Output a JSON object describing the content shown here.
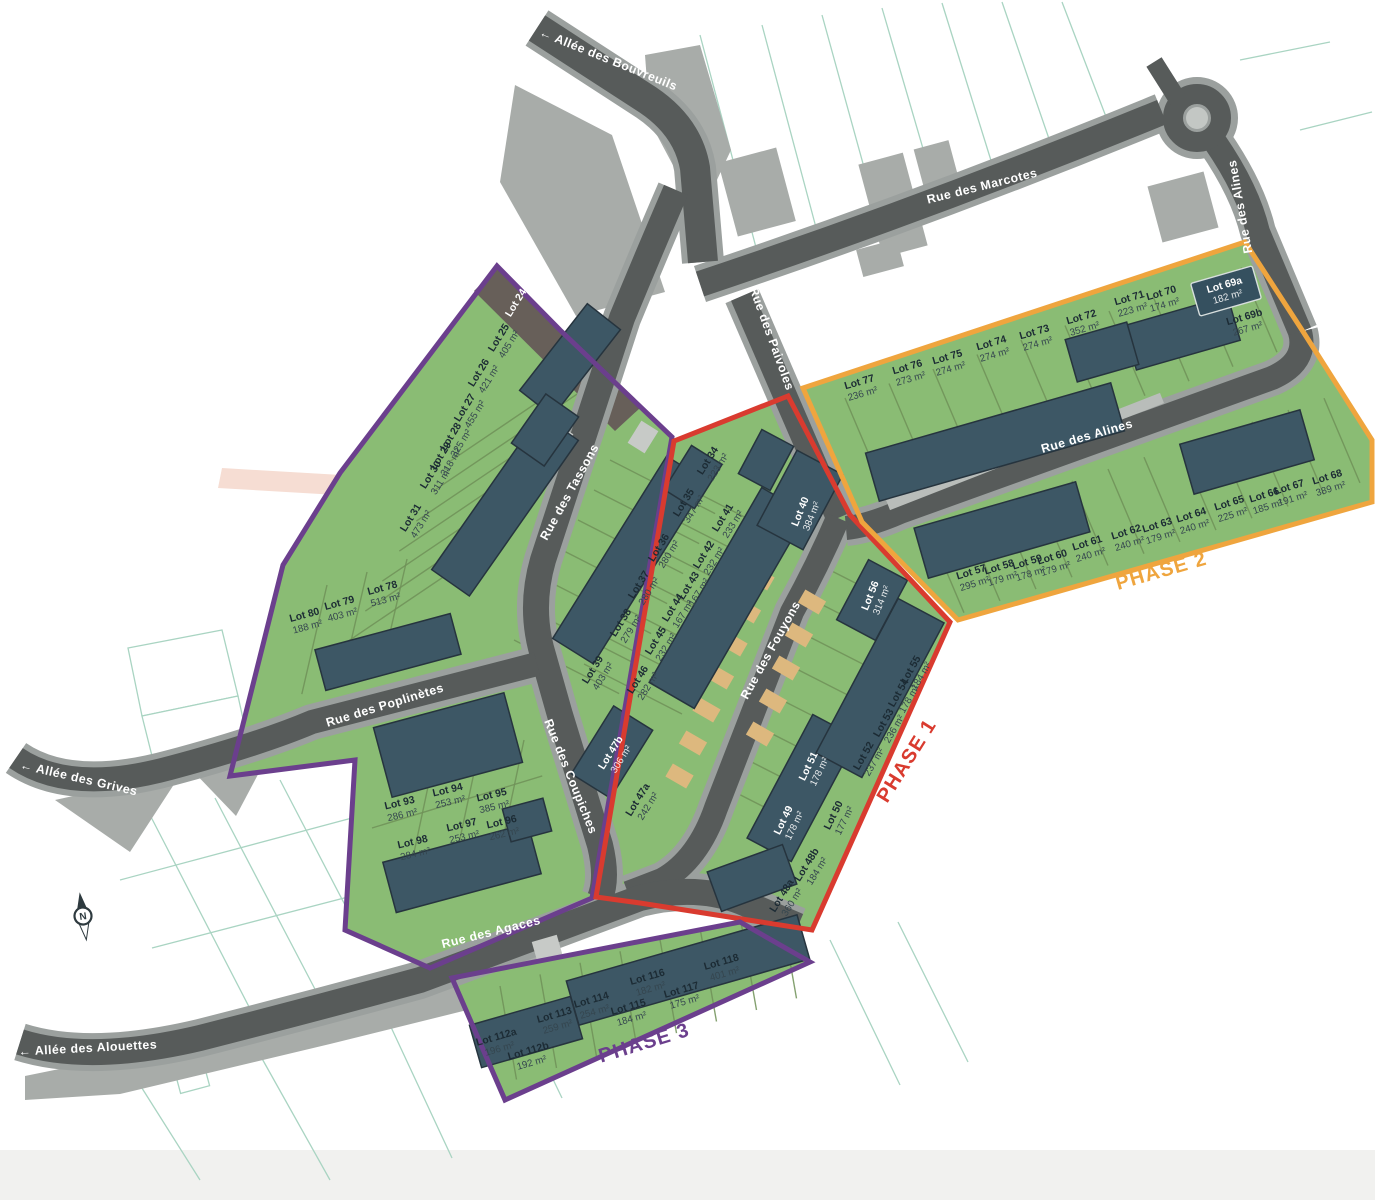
{
  "map_type": "residential-subdivision-plan",
  "colors": {
    "road": "#575b5a",
    "road_casing": "#9ba09e",
    "parcel_green": "#8abc74",
    "divider_green": "#6f9158",
    "building": "#3d5765",
    "building_outline": "#26343e",
    "existing_gray": "#a8aca9",
    "driveway_tan": "#ddb87e",
    "pad_gray": "#c7cac7",
    "phase1_red": "#d93b2f",
    "phase2_orange": "#efa53e",
    "phase3_purple": "#6b3f8d",
    "parcel_line_teal": "#a9d4c2",
    "label_dark": "#1c2b34",
    "label_area_dark": "#35464f",
    "label_white": "#ffffff",
    "lot24_strip": "#675f59",
    "bottom_band": "#f1f1ef",
    "pink_zone": "#f6ddd3"
  },
  "north": {
    "label": "N",
    "x": 83,
    "y": 916
  },
  "streets": [
    {
      "name": "← Allée des Bouvreuils",
      "x": 607,
      "y": 63,
      "rot": 22
    },
    {
      "name": "Rue des Marcotes",
      "x": 983,
      "y": 190,
      "rot": -14
    },
    {
      "name": "Rue des Alines",
      "x": 1244,
      "y": 206,
      "rot": -100
    },
    {
      "name": "Rue des Alines",
      "x": 1088,
      "y": 440,
      "rot": -16
    },
    {
      "name": "Rue des Paivoles",
      "x": 768,
      "y": 340,
      "rot": 70
    },
    {
      "name": "Rue des Tassons",
      "x": 573,
      "y": 494,
      "rot": -61
    },
    {
      "name": "Rue des Fouyons",
      "x": 774,
      "y": 652,
      "rot": -61
    },
    {
      "name": "Rue des Poplinètes",
      "x": 386,
      "y": 709,
      "rot": -17
    },
    {
      "name": "Rue des Coupiches",
      "x": 567,
      "y": 778,
      "rot": 68
    },
    {
      "name": "Rue des Agaces",
      "x": 492,
      "y": 936,
      "rot": -14
    },
    {
      "name": "← Allée des Grives",
      "x": 78,
      "y": 782,
      "rot": 13
    },
    {
      "name": "← Allée des Alouettes",
      "x": 88,
      "y": 1052,
      "rot": -3
    }
  ],
  "phases": [
    {
      "name": "PHASE 1",
      "color": "#d93b2f",
      "x": 912,
      "y": 764,
      "rot": -58
    },
    {
      "name": "PHASE 2",
      "color": "#efa53e",
      "x": 1163,
      "y": 577,
      "rot": -16
    },
    {
      "name": "PHASE 3",
      "color": "#6b3f8d",
      "x": 646,
      "y": 1049,
      "rot": -17
    }
  ],
  "lots": [
    {
      "id": "Lot 24",
      "area": null,
      "x": 516,
      "y": 303,
      "rot": -58,
      "white": true
    },
    {
      "id": "Lot 25",
      "area": "405 m²",
      "x": 504,
      "y": 341,
      "rot": -58
    },
    {
      "id": "Lot 26",
      "area": "421 m²",
      "x": 484,
      "y": 376,
      "rot": -58
    },
    {
      "id": "Lot 27",
      "area": "455 m²",
      "x": 470,
      "y": 411,
      "rot": -58
    },
    {
      "id": "Lot 28",
      "area": "325 m²",
      "x": 456,
      "y": 440,
      "rot": -58
    },
    {
      "id": "Lot 29",
      "area": "318 m²",
      "x": 446,
      "y": 459,
      "rot": -58
    },
    {
      "id": "Lot 30",
      "area": "311 m²",
      "x": 436,
      "y": 478,
      "rot": -58
    },
    {
      "id": "Lot 31",
      "area": "473 m²",
      "x": 416,
      "y": 521,
      "rot": -58
    },
    {
      "id": "Lot 34",
      "area": "223 m²",
      "x": 713,
      "y": 464,
      "rot": -58
    },
    {
      "id": "Lot 35",
      "area": "347 m²",
      "x": 689,
      "y": 506,
      "rot": -58
    },
    {
      "id": "Lot 36",
      "area": "280 m²",
      "x": 664,
      "y": 551,
      "rot": -58
    },
    {
      "id": "Lot 37",
      "area": "280 m²",
      "x": 644,
      "y": 588,
      "rot": -58
    },
    {
      "id": "Lot 38",
      "area": "279 m²",
      "x": 626,
      "y": 626,
      "rot": -58
    },
    {
      "id": "Lot 39",
      "area": "403 m²",
      "x": 598,
      "y": 673,
      "rot": -58
    },
    {
      "id": "Lot 40",
      "area": "384 m²",
      "x": 806,
      "y": 514,
      "rot": -68,
      "white": true
    },
    {
      "id": "Lot 41",
      "area": "233 m²",
      "x": 728,
      "y": 521,
      "rot": -58
    },
    {
      "id": "Lot 42",
      "area": "232 m²",
      "x": 709,
      "y": 558,
      "rot": -58
    },
    {
      "id": "Lot 43",
      "area": "167 m²",
      "x": 694,
      "y": 589,
      "rot": -58
    },
    {
      "id": "Lot 44",
      "area": "167 m²",
      "x": 678,
      "y": 611,
      "rot": -58
    },
    {
      "id": "Lot 45",
      "area": "232 m²",
      "x": 661,
      "y": 644,
      "rot": -58
    },
    {
      "id": "Lot 46",
      "area": "282 m²",
      "x": 643,
      "y": 683,
      "rot": -58
    },
    {
      "id": "Lot 47b",
      "area": "306 m²",
      "x": 616,
      "y": 756,
      "rot": -58,
      "white": true
    },
    {
      "id": "Lot 47a",
      "area": "242 m²",
      "x": 643,
      "y": 803,
      "rot": -58
    },
    {
      "id": "Lot 48a",
      "area": "360 m²",
      "x": 787,
      "y": 899,
      "rot": -58
    },
    {
      "id": "Lot 48b",
      "area": "184 m²",
      "x": 812,
      "y": 868,
      "rot": -58
    },
    {
      "id": "Lot 49",
      "area": "178 m²",
      "x": 789,
      "y": 823,
      "rot": -64,
      "white": true
    },
    {
      "id": "Lot 50",
      "area": "177 m²",
      "x": 839,
      "y": 818,
      "rot": -64
    },
    {
      "id": "Lot 51",
      "area": "178 m²",
      "x": 814,
      "y": 769,
      "rot": -64,
      "white": true
    },
    {
      "id": "Lot 52",
      "area": "237 m²",
      "x": 869,
      "y": 759,
      "rot": -60
    },
    {
      "id": "Lot 53",
      "area": "236 m²",
      "x": 889,
      "y": 726,
      "rot": -60
    },
    {
      "id": "Lot 54",
      "area": "178 m²",
      "x": 904,
      "y": 696,
      "rot": -60
    },
    {
      "id": "Lot 55",
      "area": "184 m²",
      "x": 916,
      "y": 673,
      "rot": -60
    },
    {
      "id": "Lot 56",
      "area": "314 m²",
      "x": 876,
      "y": 598,
      "rot": -68,
      "white": true
    },
    {
      "id": "Lot 57",
      "area": "295 m²",
      "x": 973,
      "y": 578,
      "rot": -17
    },
    {
      "id": "Lot 58",
      "area": "179 m²",
      "x": 1001,
      "y": 573,
      "rot": -17
    },
    {
      "id": "Lot 59",
      "area": "178 m²",
      "x": 1029,
      "y": 568,
      "rot": -17
    },
    {
      "id": "Lot 60",
      "area": "179 m²",
      "x": 1054,
      "y": 563,
      "rot": -17
    },
    {
      "id": "Lot 61",
      "area": "240 m²",
      "x": 1089,
      "y": 549,
      "rot": -17
    },
    {
      "id": "Lot 62",
      "area": "240 m²",
      "x": 1128,
      "y": 538,
      "rot": -17
    },
    {
      "id": "Lot 63",
      "area": "179 m²",
      "x": 1159,
      "y": 531,
      "rot": -17
    },
    {
      "id": "Lot 64",
      "area": "240 m²",
      "x": 1193,
      "y": 521,
      "rot": -17
    },
    {
      "id": "Lot 65",
      "area": "225 m²",
      "x": 1231,
      "y": 509,
      "rot": -17
    },
    {
      "id": "Lot 66",
      "area": "185 m²",
      "x": 1266,
      "y": 501,
      "rot": -17
    },
    {
      "id": "Lot 67",
      "area": "191 m²",
      "x": 1291,
      "y": 493,
      "rot": -17
    },
    {
      "id": "Lot 68",
      "area": "389 m²",
      "x": 1329,
      "y": 483,
      "rot": -17
    },
    {
      "id": "Lot 69a",
      "area": "182 m²",
      "x": 1226,
      "y": 291,
      "rot": -16,
      "white": true,
      "badge": true
    },
    {
      "id": "Lot 69b",
      "area": "267 m²",
      "x": 1246,
      "y": 323,
      "rot": -16
    },
    {
      "id": "Lot 70",
      "area": "174 m²",
      "x": 1163,
      "y": 299,
      "rot": -16
    },
    {
      "id": "Lot 71",
      "area": "223 m²",
      "x": 1131,
      "y": 304,
      "rot": -16
    },
    {
      "id": "Lot 72",
      "area": "352 m²",
      "x": 1083,
      "y": 323,
      "rot": -16
    },
    {
      "id": "Lot 73",
      "area": "274 m²",
      "x": 1036,
      "y": 338,
      "rot": -16
    },
    {
      "id": "Lot 74",
      "area": "274 m²",
      "x": 993,
      "y": 349,
      "rot": -16
    },
    {
      "id": "Lot 75",
      "area": "274 m²",
      "x": 949,
      "y": 363,
      "rot": -16
    },
    {
      "id": "Lot 76",
      "area": "273 m²",
      "x": 909,
      "y": 373,
      "rot": -16
    },
    {
      "id": "Lot 77",
      "area": "236 m²",
      "x": 861,
      "y": 388,
      "rot": -16
    },
    {
      "id": "Lot 78",
      "area": "513 m²",
      "x": 384,
      "y": 594,
      "rot": -15
    },
    {
      "id": "Lot 79",
      "area": "403 m²",
      "x": 341,
      "y": 609,
      "rot": -15
    },
    {
      "id": "Lot 80",
      "area": "188 m²",
      "x": 306,
      "y": 621,
      "rot": -15
    },
    {
      "id": "Lot 93",
      "area": "286 m²",
      "x": 401,
      "y": 809,
      "rot": -13
    },
    {
      "id": "Lot 94",
      "area": "253 m²",
      "x": 449,
      "y": 796,
      "rot": -13
    },
    {
      "id": "Lot 95",
      "area": "385 m²",
      "x": 493,
      "y": 801,
      "rot": -13
    },
    {
      "id": "Lot 96",
      "area": "262 m²",
      "x": 503,
      "y": 828,
      "rot": -13
    },
    {
      "id": "Lot 97",
      "area": "253 m²",
      "x": 463,
      "y": 831,
      "rot": -13
    },
    {
      "id": "Lot 98",
      "area": "284 m²",
      "x": 414,
      "y": 848,
      "rot": -13
    },
    {
      "id": "Lot 112a",
      "area": "196 m²",
      "x": 498,
      "y": 1043,
      "rot": -16
    },
    {
      "id": "Lot 112b",
      "area": "192 m²",
      "x": 530,
      "y": 1057,
      "rot": -16
    },
    {
      "id": "Lot 113",
      "area": "259 m²",
      "x": 556,
      "y": 1021,
      "rot": -16
    },
    {
      "id": "Lot 114",
      "area": "254 m²",
      "x": 593,
      "y": 1006,
      "rot": -16
    },
    {
      "id": "Lot 115",
      "area": "184 m²",
      "x": 630,
      "y": 1013,
      "rot": -16
    },
    {
      "id": "Lot 116",
      "area": "182 m²",
      "x": 649,
      "y": 983,
      "rot": -16
    },
    {
      "id": "Lot 117",
      "area": "175 m²",
      "x": 683,
      "y": 996,
      "rot": -16
    },
    {
      "id": "Lot 118",
      "area": "401 m²",
      "x": 723,
      "y": 968,
      "rot": -16
    }
  ]
}
